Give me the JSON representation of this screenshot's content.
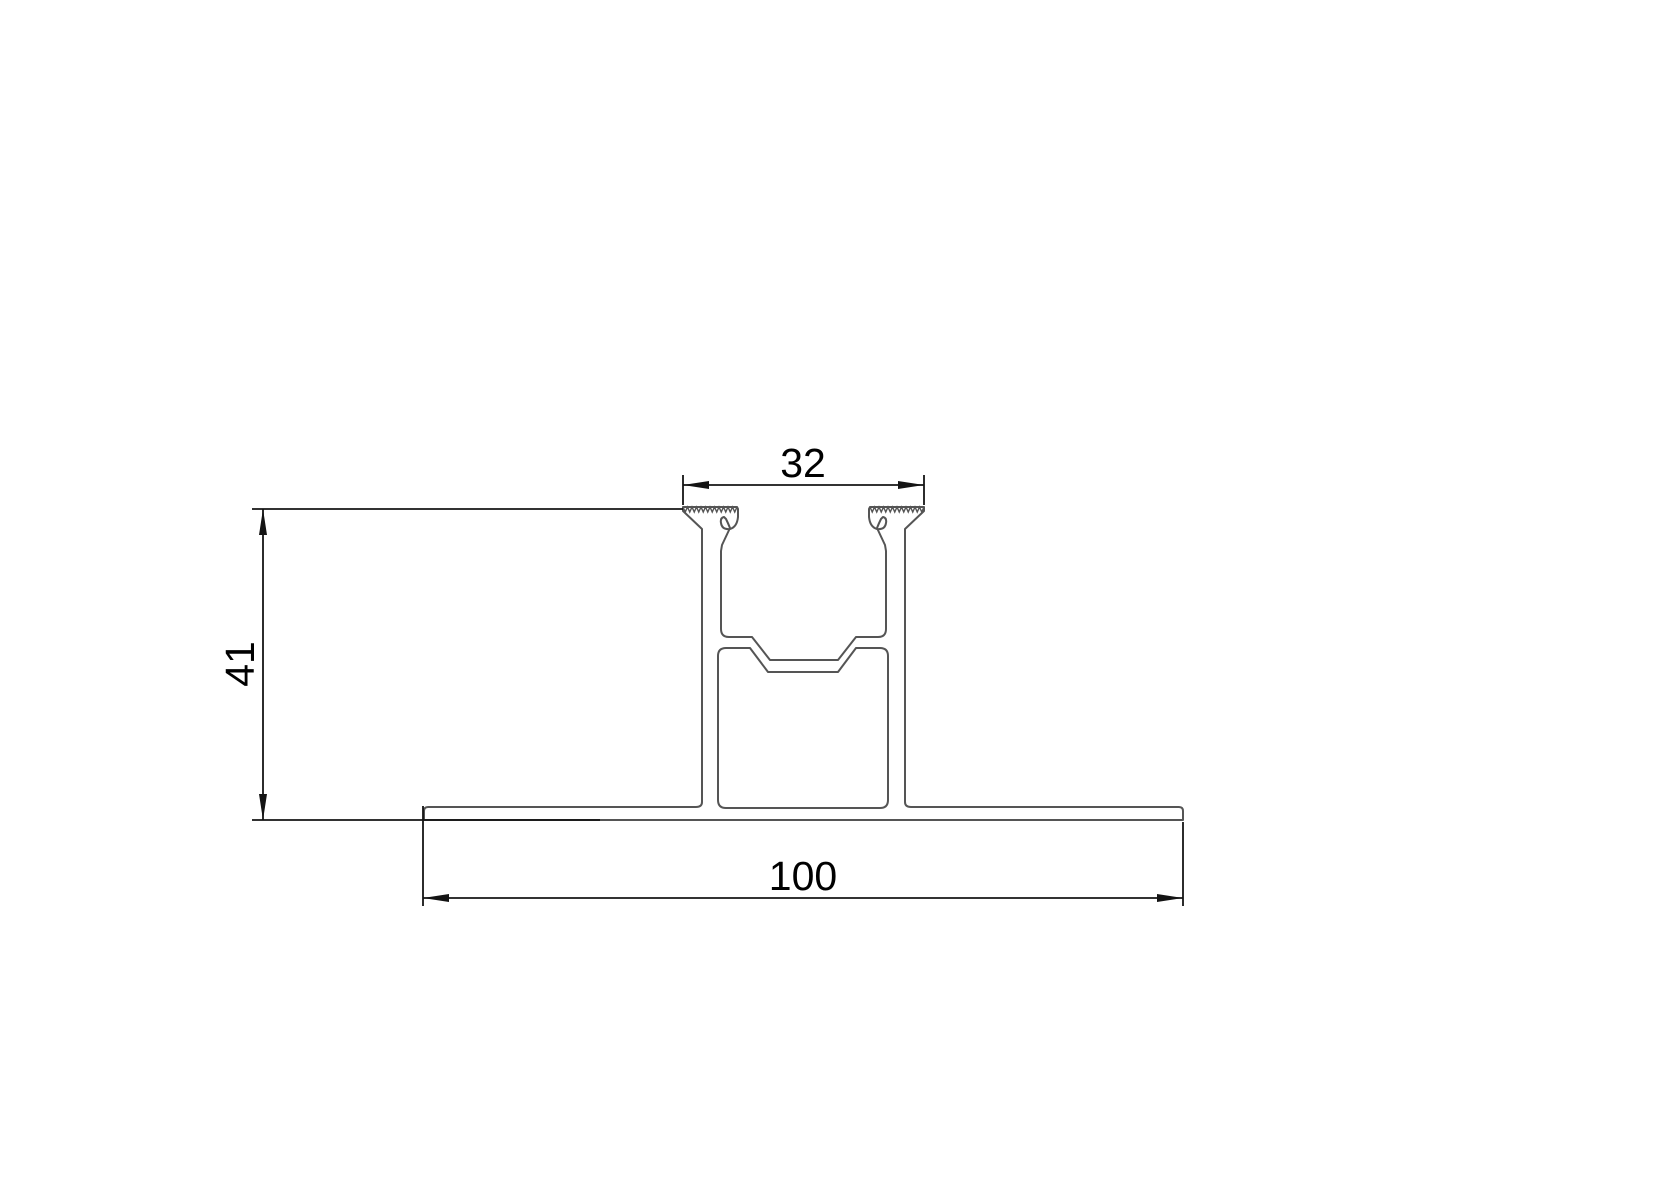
{
  "drawing": {
    "kind": "extrusion-profile-cross-section",
    "dimensions": {
      "top_width": {
        "label": "32"
      },
      "height": {
        "label": "41"
      },
      "base_width": {
        "label": "100"
      }
    },
    "colors": {
      "background": "#ffffff",
      "profile_stroke": "#555555",
      "dimension_stroke": "#141414",
      "text": "#000000"
    }
  }
}
